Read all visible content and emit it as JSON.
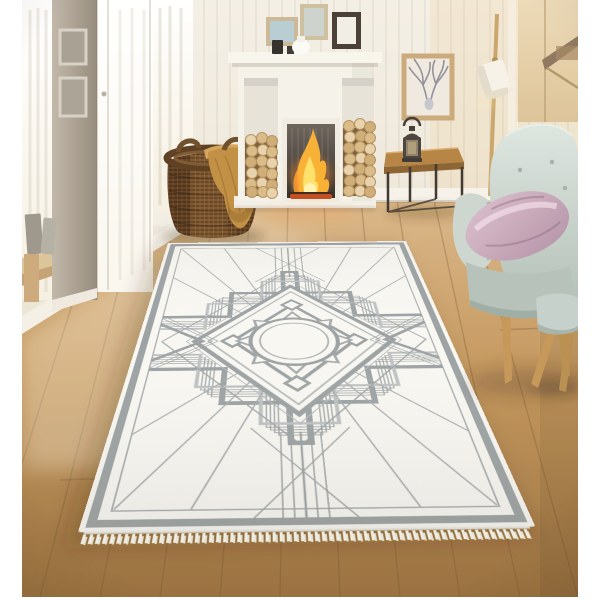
{
  "image": {
    "kind": "product-photo",
    "subject": "geometric-art-deco-area-rug-in-living-room"
  },
  "palette": {
    "margin": "#ffffff",
    "wall_cream": "#f0eadf",
    "pillar_taupe": "#a89d8f",
    "window_light": "#fdfbf5",
    "floor_oak_light": "#d8b284",
    "floor_oak_dark": "#976c3a",
    "baseboard": "#f5f1e8",
    "fireplace_white": "#f5f2ea",
    "firebox_dark": "#2e2a26",
    "flame_orange": "#ffb32e",
    "ember_red": "#c0491d",
    "log_tan": "#dcbd8a",
    "basket_brown": "#6f4b27",
    "throw_mustard": "#c08d3f",
    "deer_frame_wood": "#c9a878",
    "table_wood": "#b5803f",
    "metal_dark": "#39322b",
    "lamp_wood": "#c9a469",
    "lamp_shade": "#f6f2e8",
    "cabinet_beige": "#e3c99f",
    "chair_mint": "#c7d3cd",
    "pillow_mauve": "#c9a8ba",
    "leg_wood": "#c49555",
    "rug_ground": "#f8f7f3",
    "rug_pattern_gray": "#9aa0a2",
    "rug_pattern_light": "#bcc0c2",
    "fringe_ivory": "#efede2"
  },
  "objects": [
    "left-windows",
    "wall-pillar",
    "pillar-frames",
    "leaning-frames",
    "window-bench",
    "wicker-basket",
    "mustard-throw",
    "fireplace",
    "mantel-shelf",
    "mantel-frames",
    "mantel-decor",
    "firewood-left",
    "firewood-right",
    "fire",
    "deer-artwork",
    "side-table",
    "lantern",
    "floor-lamp",
    "shelf-cabinet",
    "armchair",
    "velvet-pillow",
    "footstool",
    "wood-floor",
    "area-rug",
    "rug-fringe"
  ]
}
